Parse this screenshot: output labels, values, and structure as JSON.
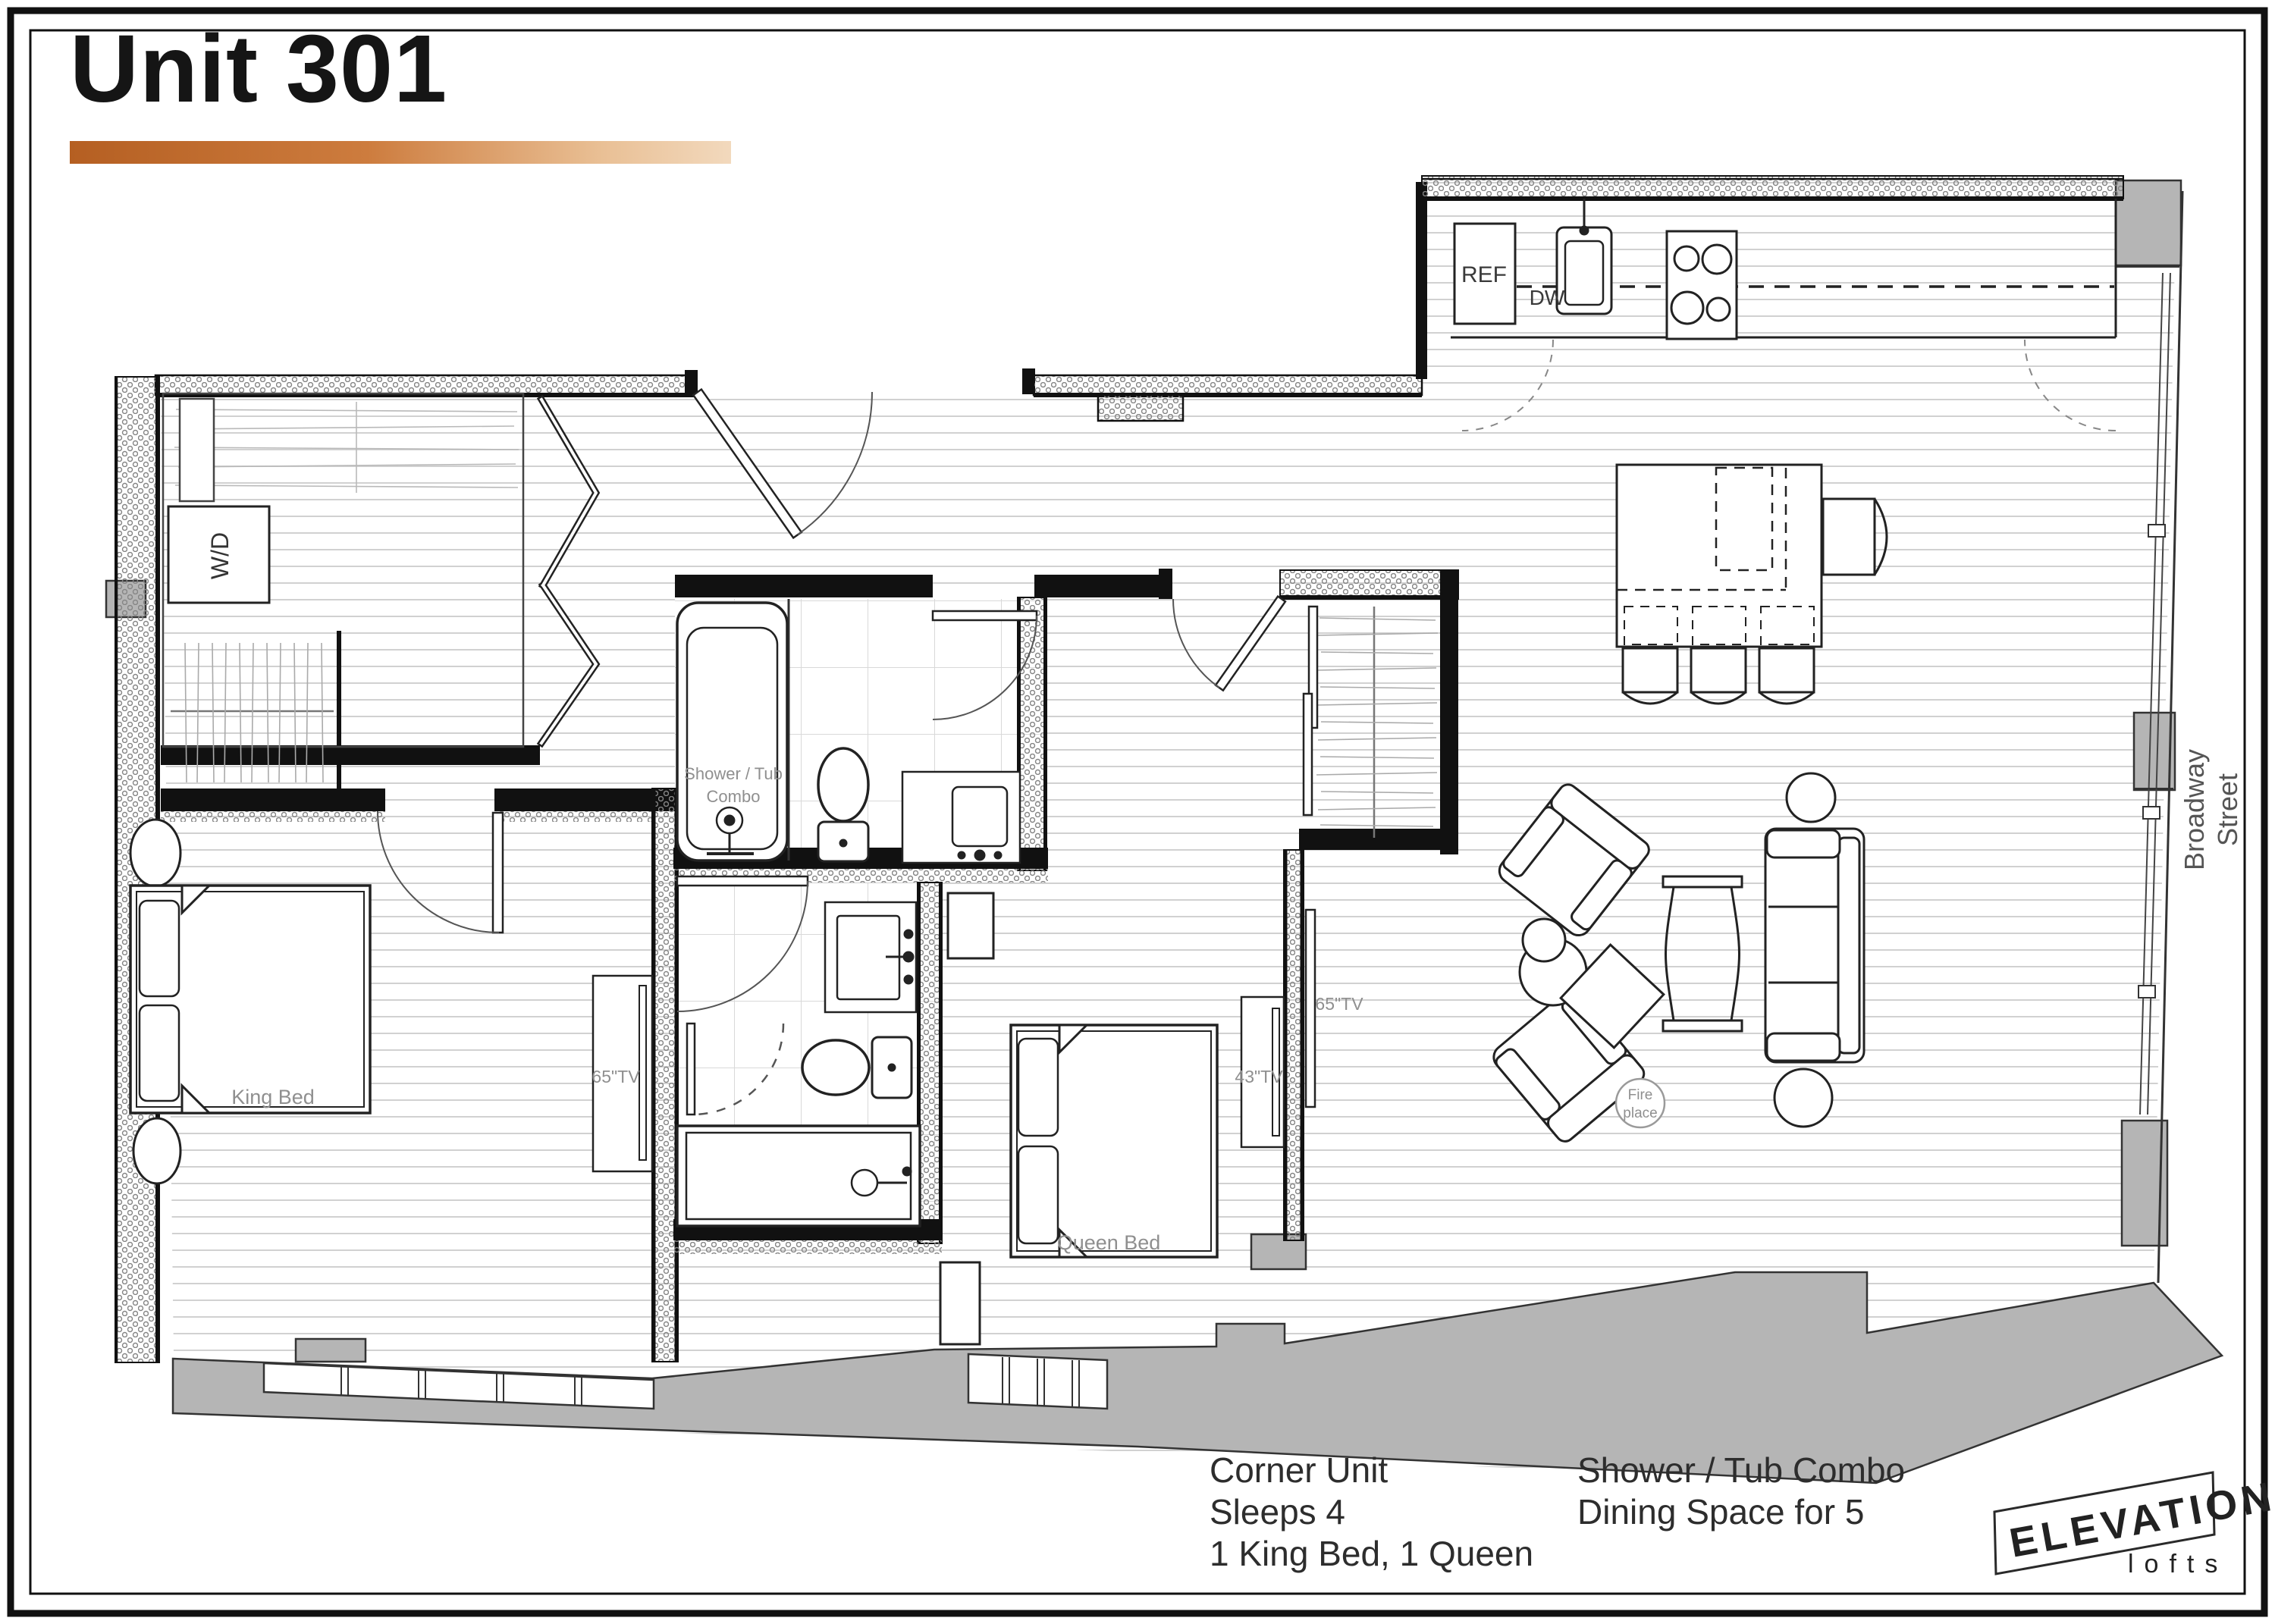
{
  "page": {
    "title": "Unit 301",
    "colors": {
      "accent_start": "#b55f22",
      "accent_end": "#f2d9bd",
      "wall": "#141414",
      "structure_gray": "#b5b5b5",
      "label_gray": "#8f8f8f",
      "floor_line": "#cfcfcf"
    }
  },
  "plan": {
    "street": {
      "line1": "Broadway",
      "line2": "Street"
    },
    "labels": {
      "washer_dryer": "W/D",
      "fridge": "REF",
      "dishwasher": "DW",
      "shower_tub_line1": "Shower / Tub",
      "shower_tub_line2": "Combo",
      "king_bed": "King Bed",
      "queen_bed": "Queen Bed",
      "tv_king": "65\"TV",
      "tv_queen": "43\"TV",
      "tv_living": "65\"TV",
      "fireplace_line1": "Fire",
      "fireplace_line2": "place"
    }
  },
  "footer": {
    "col1": [
      "Corner Unit",
      "Sleeps 4",
      "1 King Bed, 1 Queen"
    ],
    "col2": [
      "Shower / Tub Combo",
      "Dining Space for 5"
    ]
  },
  "logo": {
    "name": "ELEVATION",
    "sub": "lofts"
  }
}
